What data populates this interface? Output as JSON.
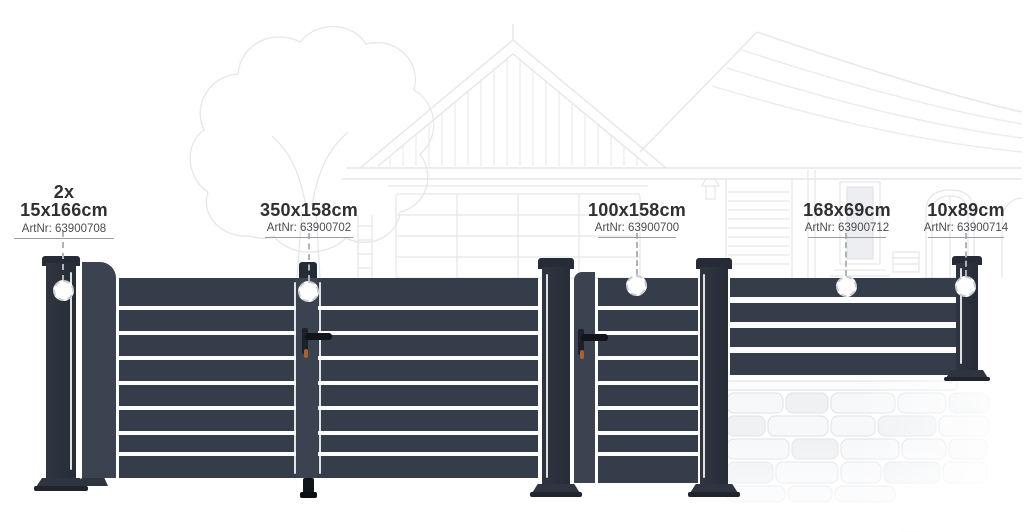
{
  "palette": {
    "fence_dark": "#353d4a",
    "post_dark": "#2e3541",
    "cap_dark": "#262c36",
    "stile": "#3b4350",
    "slat_gap": "#fbfcfd",
    "sketch_line": "#e4e5e8",
    "label_text": "#2f3033",
    "artnr_text": "#4c4d50",
    "rule_line": "#9b9da1",
    "leader_line": "#b0b3b7",
    "ring_line": "#c8cbcf",
    "lock_black": "#10141b",
    "keyhole_accent": "#a85f32"
  },
  "callouts": [
    {
      "qty": "2x",
      "dimension": "15x166cm",
      "artnr": "ArtNr: 63900708"
    },
    {
      "dimension": "350x158cm",
      "artnr": "ArtNr: 63900702"
    },
    {
      "dimension": "100x158cm",
      "artnr": "ArtNr: 63900700"
    },
    {
      "dimension": "168x69cm",
      "artnr": "ArtNr: 63900712"
    },
    {
      "dimension": "10x89cm",
      "artnr": "ArtNr: 63900714"
    }
  ]
}
